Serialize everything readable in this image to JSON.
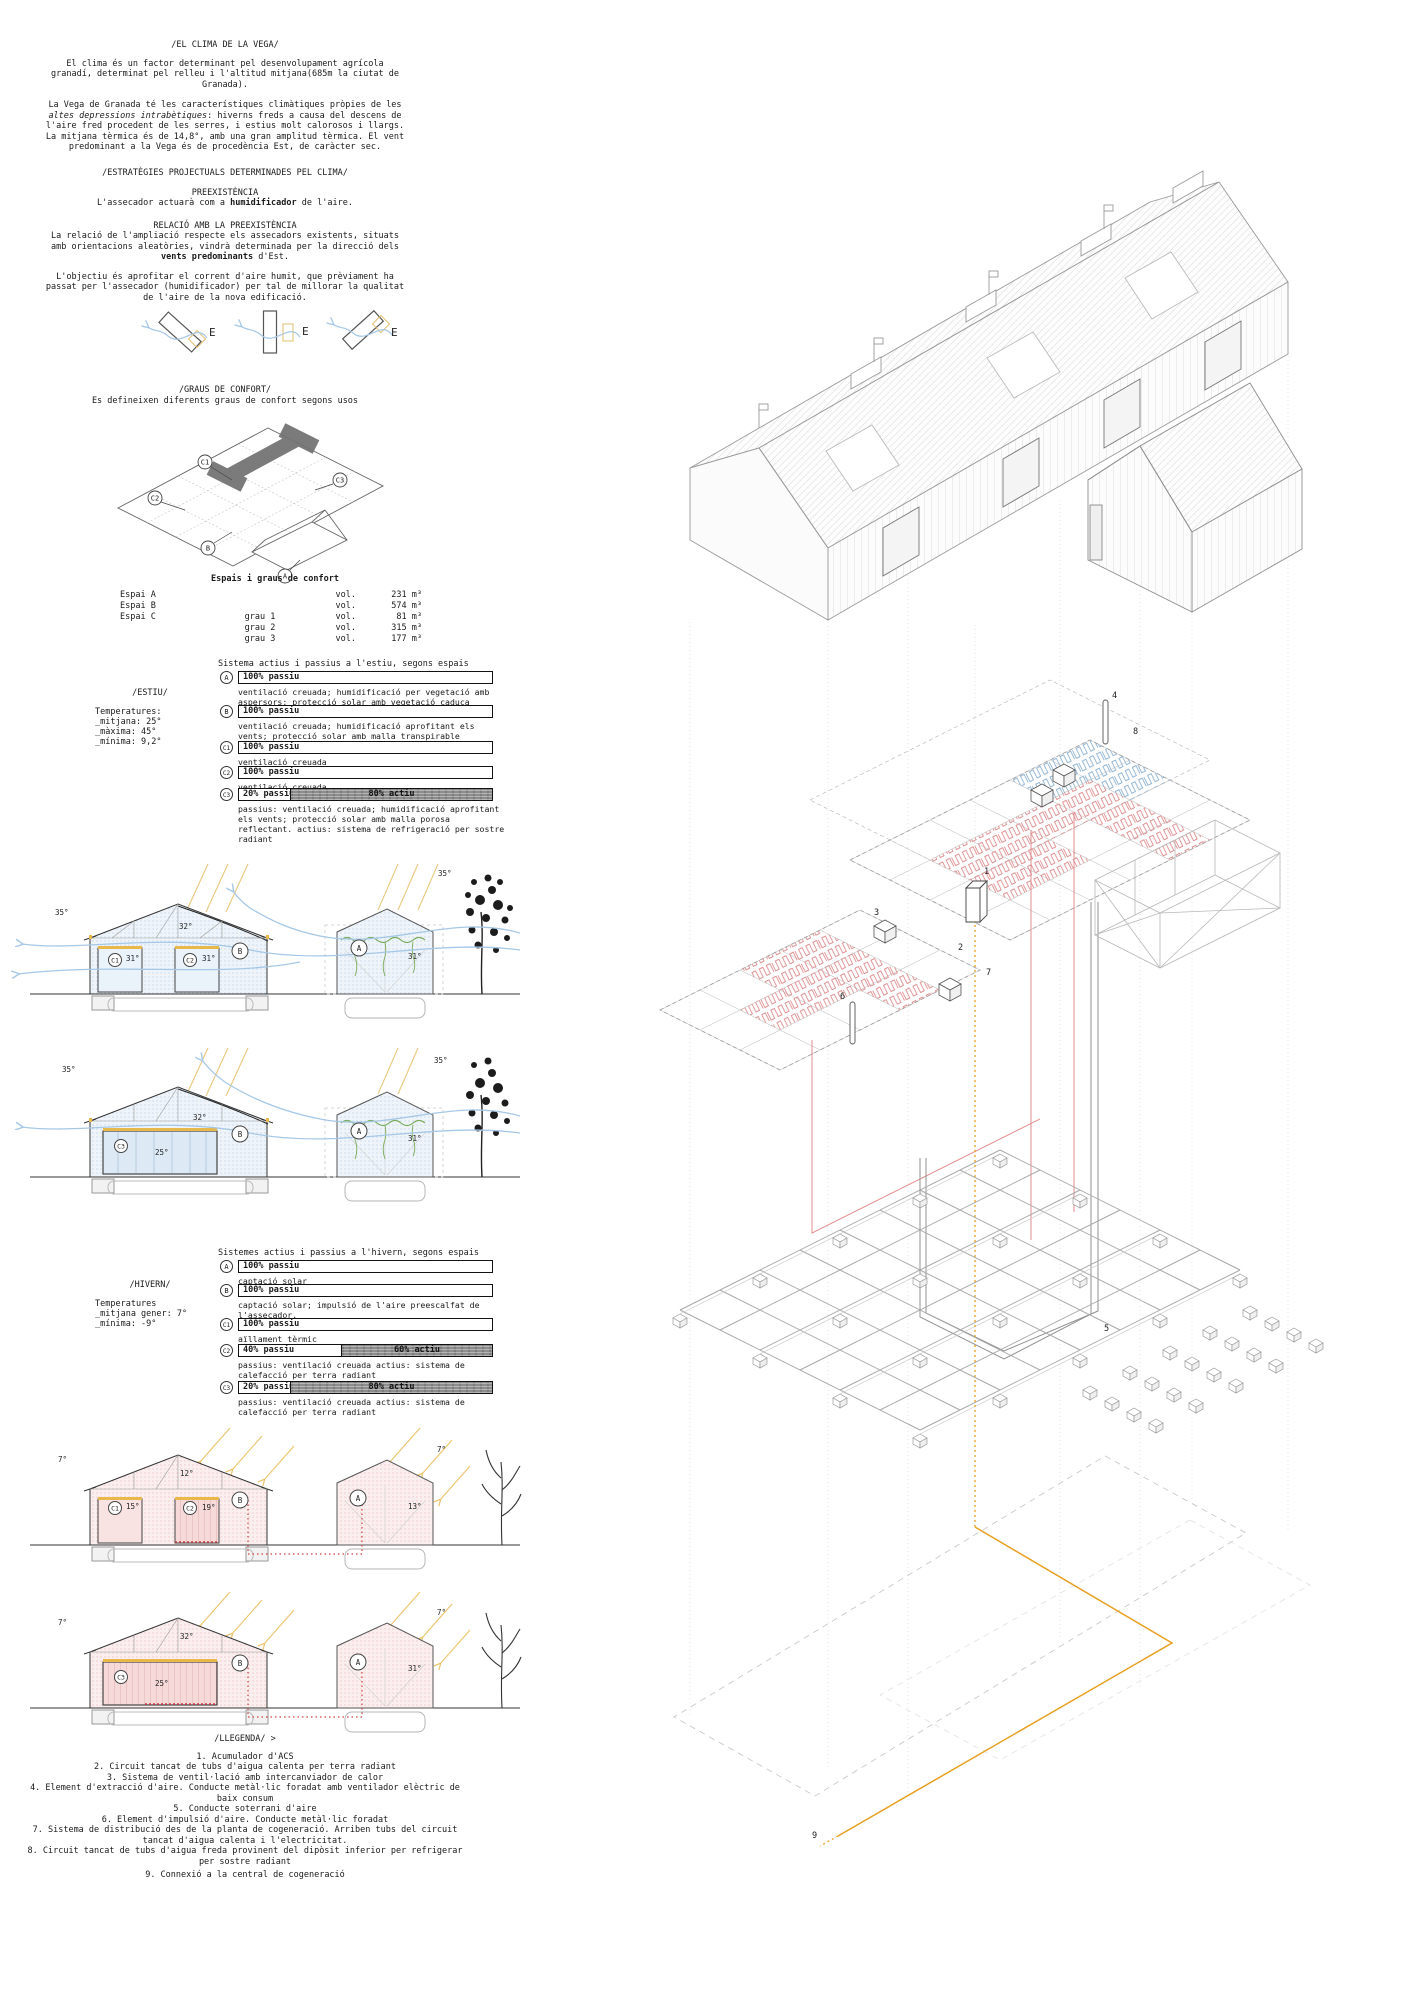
{
  "clima": {
    "title": "/EL CLIMA DE LA VEGA/",
    "p1": "El clima és un factor determinant pel desenvolupament agrícola granadí, determinat pel relleu i l'altitud mitjana(685m la ciutat de Granada).",
    "p2a": "La Vega de Granada té les característiques climàtiques pròpies de les ",
    "p2b": "altes depressions intrabètiques",
    "p2c": ": hiverns freds a causa del descens de l'aire fred procedent de les serres, i estius molt calorosos i llargs. La mitjana tèrmica és de 14,8°, amb una gran amplitud tèrmica. El vent predominant a la Vega és de procedència Est, de caràcter sec."
  },
  "estrategies": {
    "title": "/ESTRATÈGIES PROJECTUALS DETERMINADES PEL CLIMA/",
    "pre_title": "PREEXISTÈNCIA",
    "pre_a": "L'assecador actuarà com a ",
    "pre_b": "humidificador",
    "pre_c": " de l'aire.",
    "rel_title": "RELACIÓ AMB LA PREEXISTÈNCIA",
    "rel_a": "La relació de l'ampliació respecte els assecadors existents, situats amb orientacions aleatòries, vindrà determinada per la direcció dels ",
    "rel_b": "vents predominants",
    "rel_c": " d'Est.",
    "objectiu": "L'objectiu és aprofitar el corrent d'aire humit, que prèviament ha passat per l'assecador (humidificador) per tal de millorar la qualitat de l'aire de la nova edificació."
  },
  "vents": {
    "labels": [
      "E",
      "E",
      "E"
    ]
  },
  "graus": {
    "title": "/GRAUS DE CONFORT/",
    "subtitle": "Es defineixen diferents graus de confort segons usos",
    "espais": [
      "C1",
      "C2",
      "C3",
      "B",
      "A"
    ]
  },
  "taula": {
    "title": "Espais i graus de confort",
    "rows": [
      {
        "espai": "Espai A",
        "grau": "",
        "vol": "vol.",
        "valor": "231 m³"
      },
      {
        "espai": "Espai B",
        "grau": "",
        "vol": "vol.",
        "valor": "574 m³"
      },
      {
        "espai": "Espai C",
        "grau": "grau 1",
        "vol": "vol.",
        "valor": "81 m³"
      },
      {
        "espai": "",
        "grau": "grau 2",
        "vol": "vol.",
        "valor": "315 m³"
      },
      {
        "espai": "",
        "grau": "grau 3",
        "vol": "vol.",
        "valor": "177 m³"
      }
    ]
  },
  "estiu": {
    "season": "/ESTIU/",
    "temps": [
      "Temperatures:",
      "_mitjana: 25°",
      "_màxima: 45°",
      "_mínima: 9,2°"
    ],
    "header": "Sistema actius i passius a l'estiu, segons espais",
    "rows": [
      {
        "id": "A",
        "passiu": "100% passiu",
        "actiu": "",
        "desc": "ventilació creuada; humidificació per vegetació amb aspersors; protecció solar amb vegetació caduca"
      },
      {
        "id": "B",
        "passiu": "100% passiu",
        "actiu": "",
        "desc": "ventilació creuada; humidificació aprofitant els vents; protecció solar amb malla transpirable reflectant"
      },
      {
        "id": "C1",
        "passiu": "100% passiu",
        "actiu": "",
        "desc": "ventilació creuada"
      },
      {
        "id": "C2",
        "passiu": "100% passiu",
        "actiu": "",
        "desc": "ventilació creuada"
      },
      {
        "id": "C3",
        "passiu": "20% passiu",
        "actiu": "80% actiu",
        "desc": "passius: ventilació creuada; humidificació aprofitant els vents; protecció solar amb malla porosa reflectant. actius: sistema de refrigeració per sostre radiant"
      }
    ]
  },
  "hivern": {
    "season": "/HIVERN/",
    "temps": [
      "Temperatures",
      "_mitjana gener: 7°",
      "_mínima: -9°"
    ],
    "header": "Sistemes actius i passius a l'hivern, segons espais",
    "rows": [
      {
        "id": "A",
        "passiu": "100% passiu",
        "actiu": "",
        "desc": "captació solar"
      },
      {
        "id": "B",
        "passiu": "100% passiu",
        "actiu": "",
        "desc": "captació solar; impulsió de l'aire preescalfat de l'assecador."
      },
      {
        "id": "C1",
        "passiu": "100% passiu",
        "actiu": "",
        "desc": "aïllament tèrmic"
      },
      {
        "id": "C2",
        "passiu": "40% passiu",
        "actiu": "60% actiu",
        "desc": "passius: ventilació creuada  actius: sistema de calefacció per terra radiant"
      },
      {
        "id": "C3",
        "passiu": "20% passiu",
        "actiu": "80% actiu",
        "desc": "passius: ventilació creuada  actius: sistema de calefacció per terra radiant"
      }
    ]
  },
  "sections": {
    "s1": {
      "out_l": "35°",
      "out_r": "35°",
      "roof": "32°",
      "r1": "C1",
      "t1": "31°",
      "r2": "C2",
      "t2": "31°",
      "b": "B",
      "a": "A",
      "ta": "31°"
    },
    "s2": {
      "out_l": "35°",
      "out_r": "35°",
      "roof": "32°",
      "r1": "C3",
      "t1": "25°",
      "b": "B",
      "a": "A",
      "ta": "31°"
    },
    "w1": {
      "out_l": "7°",
      "out_r": "7°",
      "roof": "12°",
      "r1": "C1",
      "t1": "15°",
      "r2": "C2",
      "t2": "19°",
      "b": "B",
      "a": "A",
      "ta": "13°"
    },
    "w2": {
      "out_l": "7°",
      "out_r": "7°",
      "roof": "32°",
      "r1": "C3",
      "t1": "25°",
      "b": "B",
      "a": "A",
      "ta": "31°"
    }
  },
  "llegenda": {
    "title": "/LLEGENDA/ >",
    "items": [
      "1. Acumulador d'ACS",
      "2. Circuit tancat de tubs d'aigua calenta per terra radiant",
      "3. Sistema de ventil·lació amb intercanviador de calor",
      "4. Element d'extracció d'aire. Conducte metàl·lic foradat amb ventilador elèctric de baix consum",
      "5. Conducte soterrani d'aire",
      "6. Element d'impulsió d'aire.  Conducte metàl·lic foradat",
      "7. Sistema de distribució des de la planta de cogeneració. Arriben tubs del circuit tancat d'aigua calenta i l'electricitat.",
      "8. Circuit tancat de tubs d'aigua freda provinent del dipòsit inferior per refrigerar per sostre radiant",
      "9. Connexió a la central de cogeneració"
    ]
  },
  "axon": {
    "callouts": [
      "1",
      "2",
      "3",
      "4",
      "5",
      "6",
      "7",
      "8",
      "9"
    ]
  },
  "colors": {
    "accent_orange": "#e8a020",
    "accent_yellow": "#e8c878",
    "accent_blue": "#4a86c8",
    "wind_blue": "#a6c8e6",
    "heat_red": "#d04040",
    "coil_red": "#e09090",
    "coil_blue": "#90b4d4",
    "veg_green": "#7aab5a",
    "active_grey": "#8d8d8d"
  }
}
